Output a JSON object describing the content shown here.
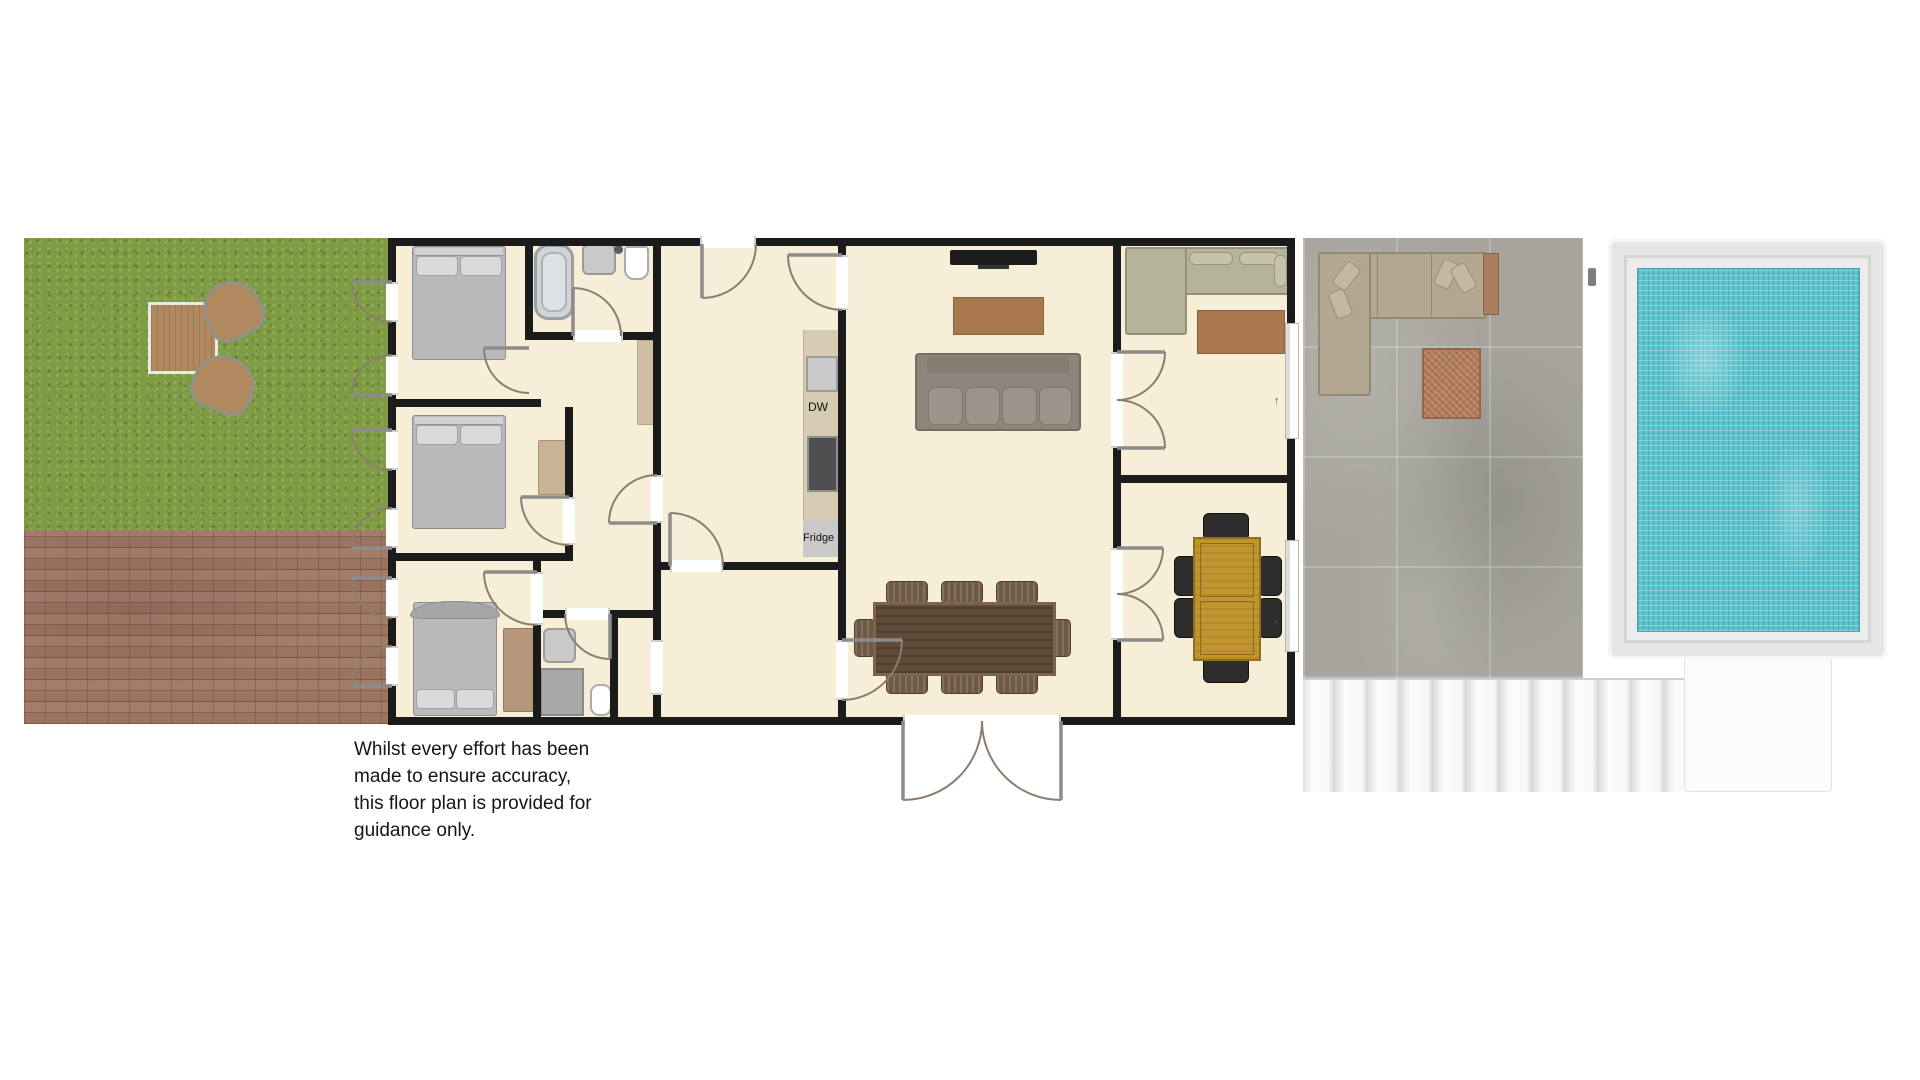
{
  "labels": {
    "dishwasher": "DW",
    "fridge": "Fridge",
    "slider_arrow": "↑"
  },
  "disclaimer": [
    "Whilst every effort has been",
    "made to ensure accuracy,",
    "this floor plan is provided for",
    "guidance only."
  ],
  "colors": {
    "floor": "#f6eed6",
    "wall": "#1b1b1b",
    "grass": "#7e9c45",
    "brick": "#9c7260",
    "patio": "#a6a49c",
    "pool_water": "#5ec3ce",
    "pool_deck": "#ececec",
    "kitchen_counter": "#d6ccb3",
    "desk_oak": "#c2952f",
    "dining_wood": "#5f4b38"
  }
}
